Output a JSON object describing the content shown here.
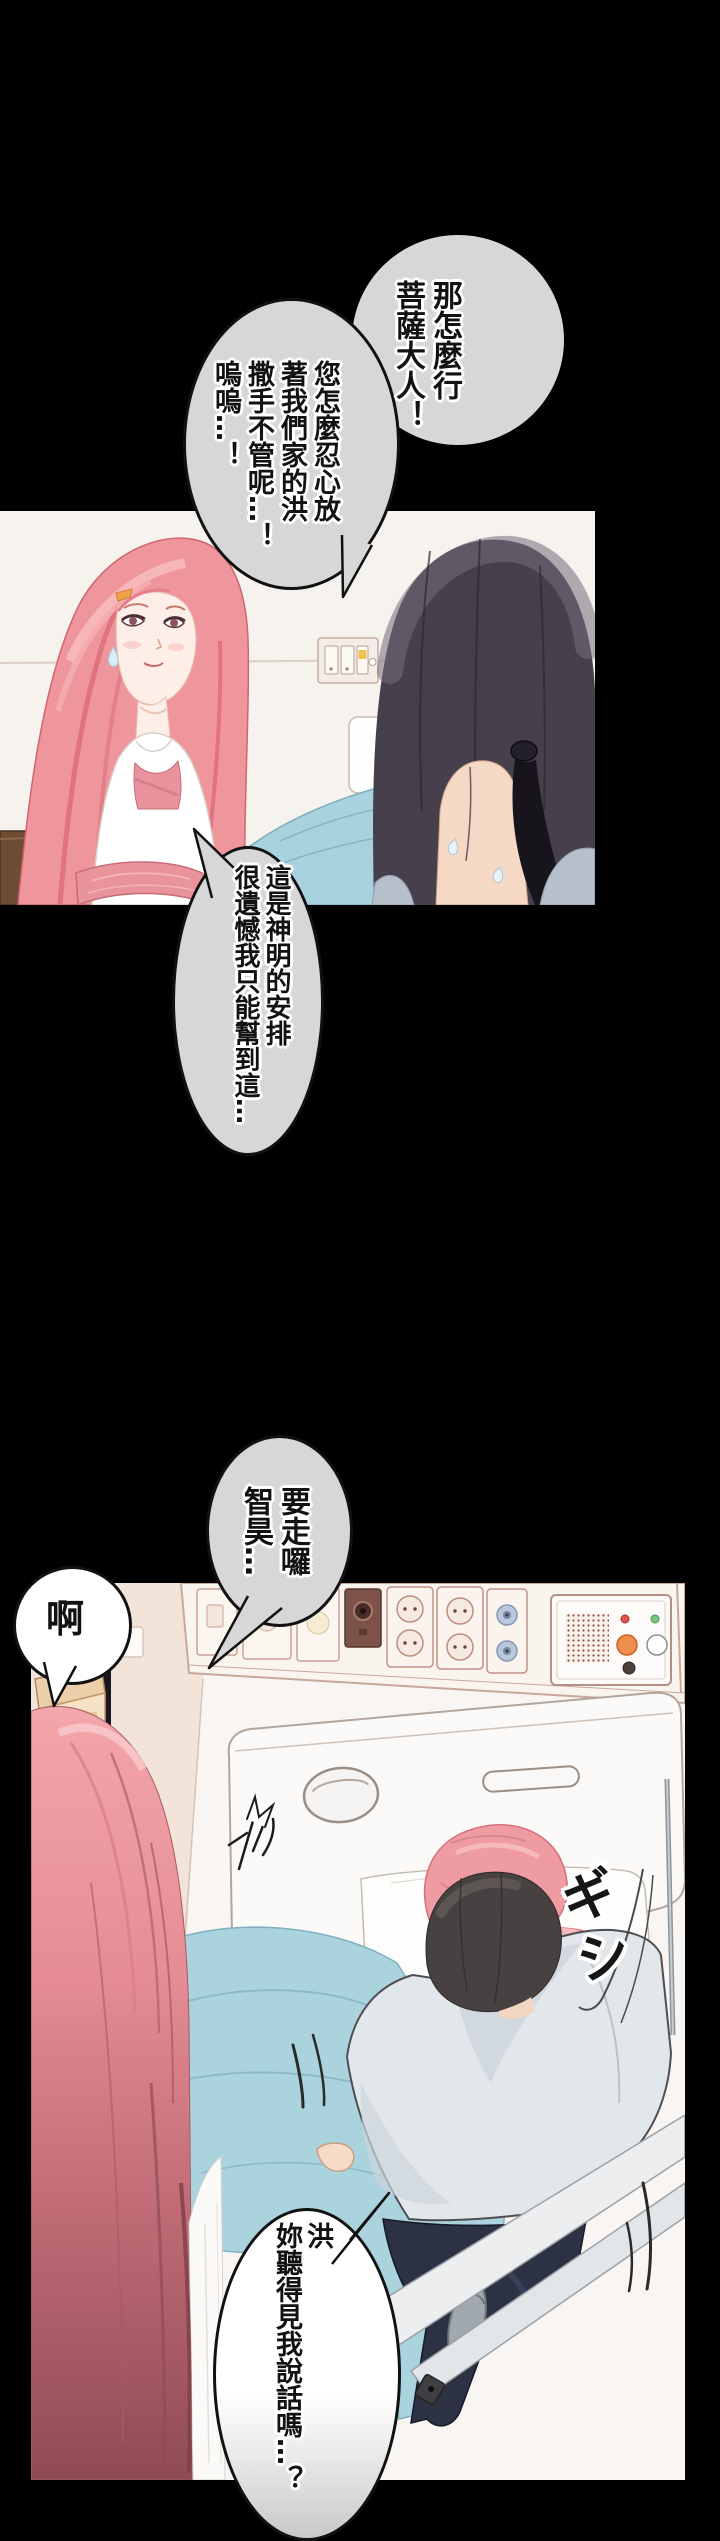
{
  "page": {
    "kind": "webtoon-comic-page",
    "width": 720,
    "height": 2541,
    "background": "#000000"
  },
  "panels": [
    {
      "id": "panel-1",
      "label": "hospital room conversation"
    },
    {
      "id": "panel-2",
      "label": "hospital bed scene"
    }
  ],
  "bubbles": {
    "top_right": {
      "lines": [
        "那怎麼行",
        "菩薩大人！"
      ],
      "fill": "#d7d7d7"
    },
    "top_left": {
      "lines": [
        "您怎麼忍心放",
        "著我們家的洪",
        "撒手不管呢…！",
        "嗚嗚…！"
      ],
      "fill": "#d7d7d7"
    },
    "middle": {
      "lines": [
        "這是神明的安排",
        "很遺憾我只能幫到這…"
      ],
      "fill": "#d7d7d7"
    },
    "leaving": {
      "lines": [
        "要走囉",
        "智昊…"
      ],
      "fill": "#d7d7d7"
    },
    "ah": {
      "lines": [
        "啊"
      ],
      "fill": "#ffffff"
    },
    "bottom": {
      "lines": [
        "洪",
        "妳聽得見我說話嗎…？"
      ],
      "fill": "#ffffff"
    }
  },
  "sfx": {
    "creak": "ギシ"
  },
  "colors": {
    "bubble_gray": "#d7d7d7",
    "outline_black": "#111111",
    "hair_pink": "#ef959c",
    "hair_dark": "#463f4c",
    "blanket_teal": "#aad3de",
    "wall_beige": "#f2e4d9",
    "shirt_blue": "#e2e7ec",
    "pants_navy": "#2c3144",
    "sash_pink": "#e9939d"
  }
}
